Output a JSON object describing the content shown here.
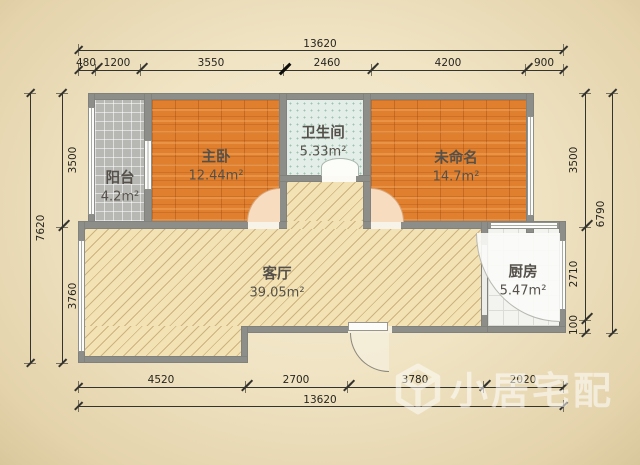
{
  "rooms": [
    {
      "name": "阳台",
      "area": "4.2m²"
    },
    {
      "name": "主卧",
      "area": "12.44m²"
    },
    {
      "name": "卫生间",
      "area": "5.33m²"
    },
    {
      "name": "未命名",
      "area": "14.7m²"
    },
    {
      "name": "客厅",
      "area": "39.05m²"
    },
    {
      "name": "厨房",
      "area": "5.47m²"
    }
  ],
  "dimensions": {
    "top_total": "13620",
    "top_segments": [
      "480",
      "1200",
      "3550",
      "2460",
      "4200",
      "900"
    ],
    "bottom_segments": [
      "4520",
      "2700",
      "3780",
      "2020"
    ],
    "bottom_total": "13620",
    "left_total": "7620",
    "left_segments": [
      "3500",
      "3760"
    ],
    "right_segments": [
      "3500",
      "2710",
      "100"
    ],
    "right_total": "6790"
  },
  "watermark": {
    "text": "小居宅配",
    "icon": "cube-icon"
  },
  "colors": {
    "wood_floor": "#e0802f",
    "balcony_tile": "#b7b7b3",
    "bath_tile": "#e3eee8",
    "living_floor": "#f2e2b4",
    "kitchen_tile": "#f3f3f0",
    "wall": "#8d8d89",
    "paper": "#f0e4c4"
  }
}
